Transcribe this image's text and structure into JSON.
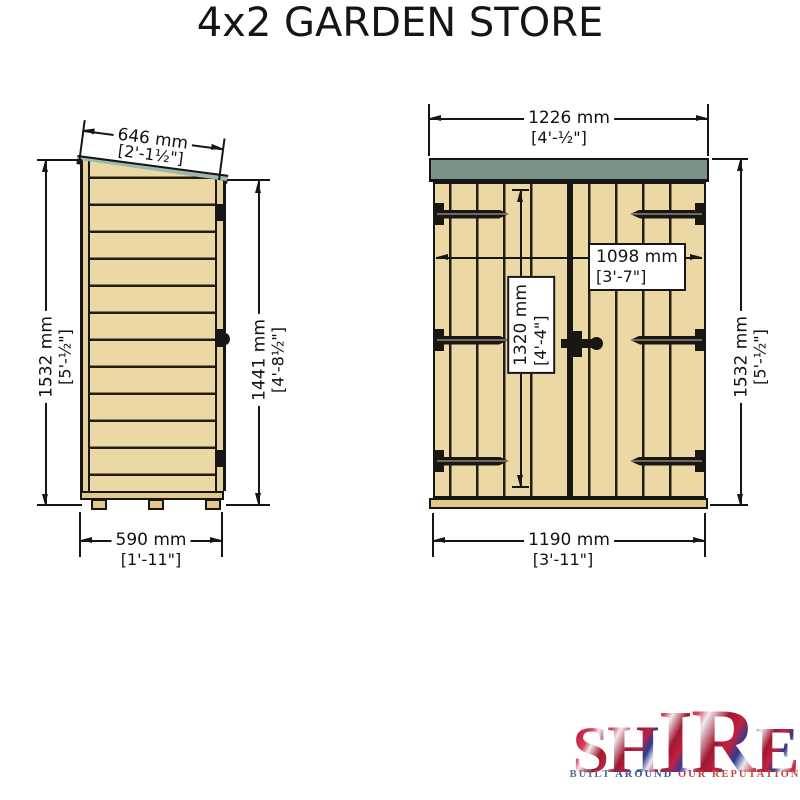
{
  "title": "4x2 GARDEN STORE",
  "side_view": {
    "dim_roof_depth": {
      "mm": "646 mm",
      "imperial": "[2'-1½\"]"
    },
    "dim_total_height": {
      "mm": "1532 mm",
      "imperial": "[5'-½\"]"
    },
    "dim_front_height": {
      "mm": "1441 mm",
      "imperial": "[4'-8½\"]"
    },
    "dim_base_depth": {
      "mm": "590 mm",
      "imperial": "[1'-11\"]"
    }
  },
  "front_view": {
    "dim_total_width": {
      "mm": "1226 mm",
      "imperial": "[4'-½\"]"
    },
    "dim_door_opening_width": {
      "mm": "1098 mm",
      "imperial": "[3'-7\"]"
    },
    "dim_door_height": {
      "mm": "1320 mm",
      "imperial": "[4'-4\"]"
    },
    "dim_total_height": {
      "mm": "1532 mm",
      "imperial": "[5'-½\"]"
    },
    "dim_base_width": {
      "mm": "1190 mm",
      "imperial": "[3'-11\"]"
    }
  },
  "logo": {
    "brand": "SHIRE",
    "letters": [
      "S",
      "H",
      "I",
      "R",
      "E"
    ],
    "tagline": "BUILT AROUND OUR REPUTATION",
    "tagline_word_colors": [
      "#5a6a96",
      "#3a4e9a",
      "#bf3848",
      "#c44f38"
    ]
  },
  "palette": {
    "wood": "#ecd8a4",
    "wood_line": "#241d12",
    "trim": "#e6d09c",
    "base_wood": "#e3c787",
    "roof_green": "#7b9287",
    "roof_edge_teal": "#9db8ac",
    "drawing_line": "#161616",
    "logo_red": "#c22040",
    "logo_blue": "#2d3b8f"
  }
}
